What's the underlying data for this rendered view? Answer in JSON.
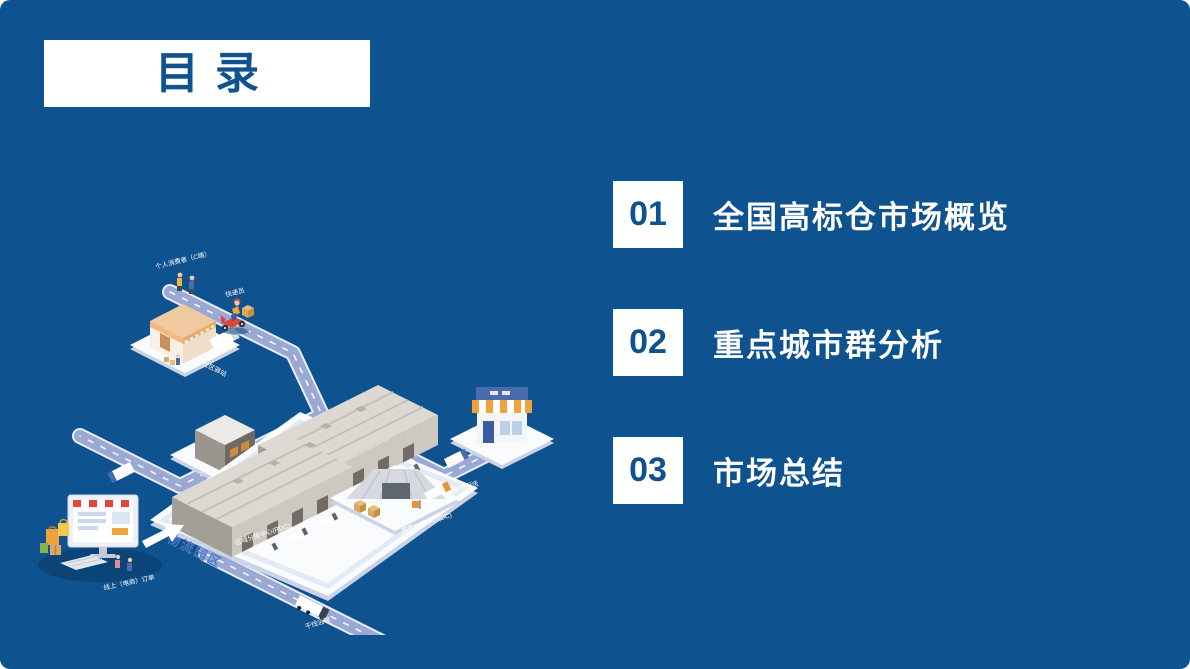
{
  "slide": {
    "title": "目录",
    "colors": {
      "background": "#0F5290",
      "text_blue": "#0F5290",
      "white": "#FFFFFF",
      "park_text": "#4E79C7"
    }
  },
  "toc": {
    "items": [
      {
        "number": "01",
        "label": "全国高标仓市场概览"
      },
      {
        "number": "02",
        "label": "重点城市群分析"
      },
      {
        "number": "03",
        "label": "市场总结"
      }
    ]
  },
  "illustration": {
    "labels": {
      "consumer": "个人消费者（C端）",
      "courier": "快递员",
      "community_station": "社区驿站",
      "express_sorting_center": "快递分拨中心",
      "logistics_park": "物流园区",
      "regional_distribution_center": "区域分拨中心(RDC)",
      "city_distribution_center": "城市分拨中心(DC)",
      "city_delivery": "城市配送",
      "trunk_transport": "干线运输",
      "offline_store": "线下门店（B端）",
      "online_order": "线上（电商）订单"
    }
  }
}
